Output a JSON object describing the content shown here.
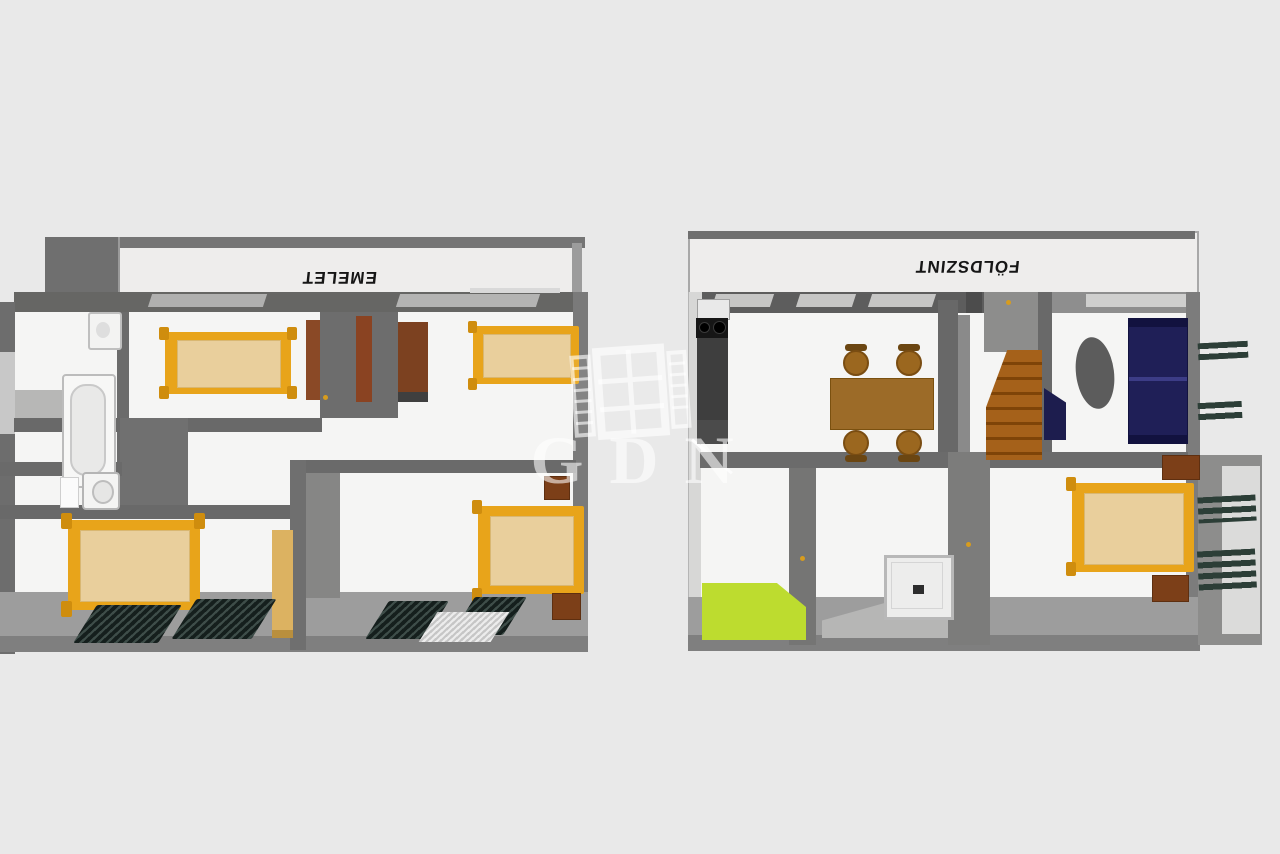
{
  "title": "3D floor plan of a two-storey apartment",
  "background_color": "#e9e9e9",
  "watermark": {
    "text": "GDN",
    "logo": "window-with-shutters-icon",
    "color": "rgba(255,255,255,0.58)"
  },
  "floors": [
    {
      "label": "EMELET",
      "rooms": [
        {
          "name": "bathroom",
          "furniture": [
            "bathtub",
            "sink",
            "toilet"
          ]
        },
        {
          "name": "bedroom-top-middle",
          "furniture": [
            "double-bed",
            "brown-door",
            "brown-door"
          ]
        },
        {
          "name": "bedroom-top-right",
          "furniture": [
            "double-bed",
            "wardrobe"
          ]
        },
        {
          "name": "bedroom-bottom-left",
          "furniture": [
            "double-bed",
            "tall-wardrobe",
            "radiator",
            "radiator"
          ]
        },
        {
          "name": "bedroom-bottom-right",
          "furniture": [
            "double-bed",
            "nightstand",
            "nightstand",
            "radiator",
            "radiator",
            "doormat"
          ]
        }
      ]
    },
    {
      "label": "FÖLDSZINT",
      "rooms": [
        {
          "name": "kitchen-dining",
          "furniture": [
            "sink-unit",
            "stove",
            "kitchen-counter",
            "dining-table",
            "chair",
            "chair",
            "chair",
            "chair"
          ]
        },
        {
          "name": "hallway",
          "furniture": [
            "staircase"
          ]
        },
        {
          "name": "living-room",
          "furniture": [
            "sofa",
            "armchair",
            "oval-coffee-table",
            "window-shutters"
          ]
        },
        {
          "name": "terrace",
          "furniture": [
            "green-floor"
          ]
        },
        {
          "name": "shower-room",
          "furniture": [
            "shower-tray"
          ]
        },
        {
          "name": "bedroom-ground",
          "furniture": [
            "double-bed",
            "nightstand",
            "nightstand",
            "window-shutters"
          ]
        }
      ]
    }
  ],
  "colors": {
    "background": "#e9e9e9",
    "wall_dark": "#6b6b6b",
    "wall_face": "#8a8a8a",
    "room_floor": "#f5f5f4",
    "bed_frame": "#e8a41a",
    "mattress": "#e9cf9c",
    "wood_dark": "#7c3f18",
    "dining_table": "#9c6b28",
    "stairs": "#a5611a",
    "sofa_navy": "#1f1f57",
    "terrace_green": "#bddc2f",
    "shutter_teal": "#2c3e37",
    "label_text": "#161616"
  }
}
